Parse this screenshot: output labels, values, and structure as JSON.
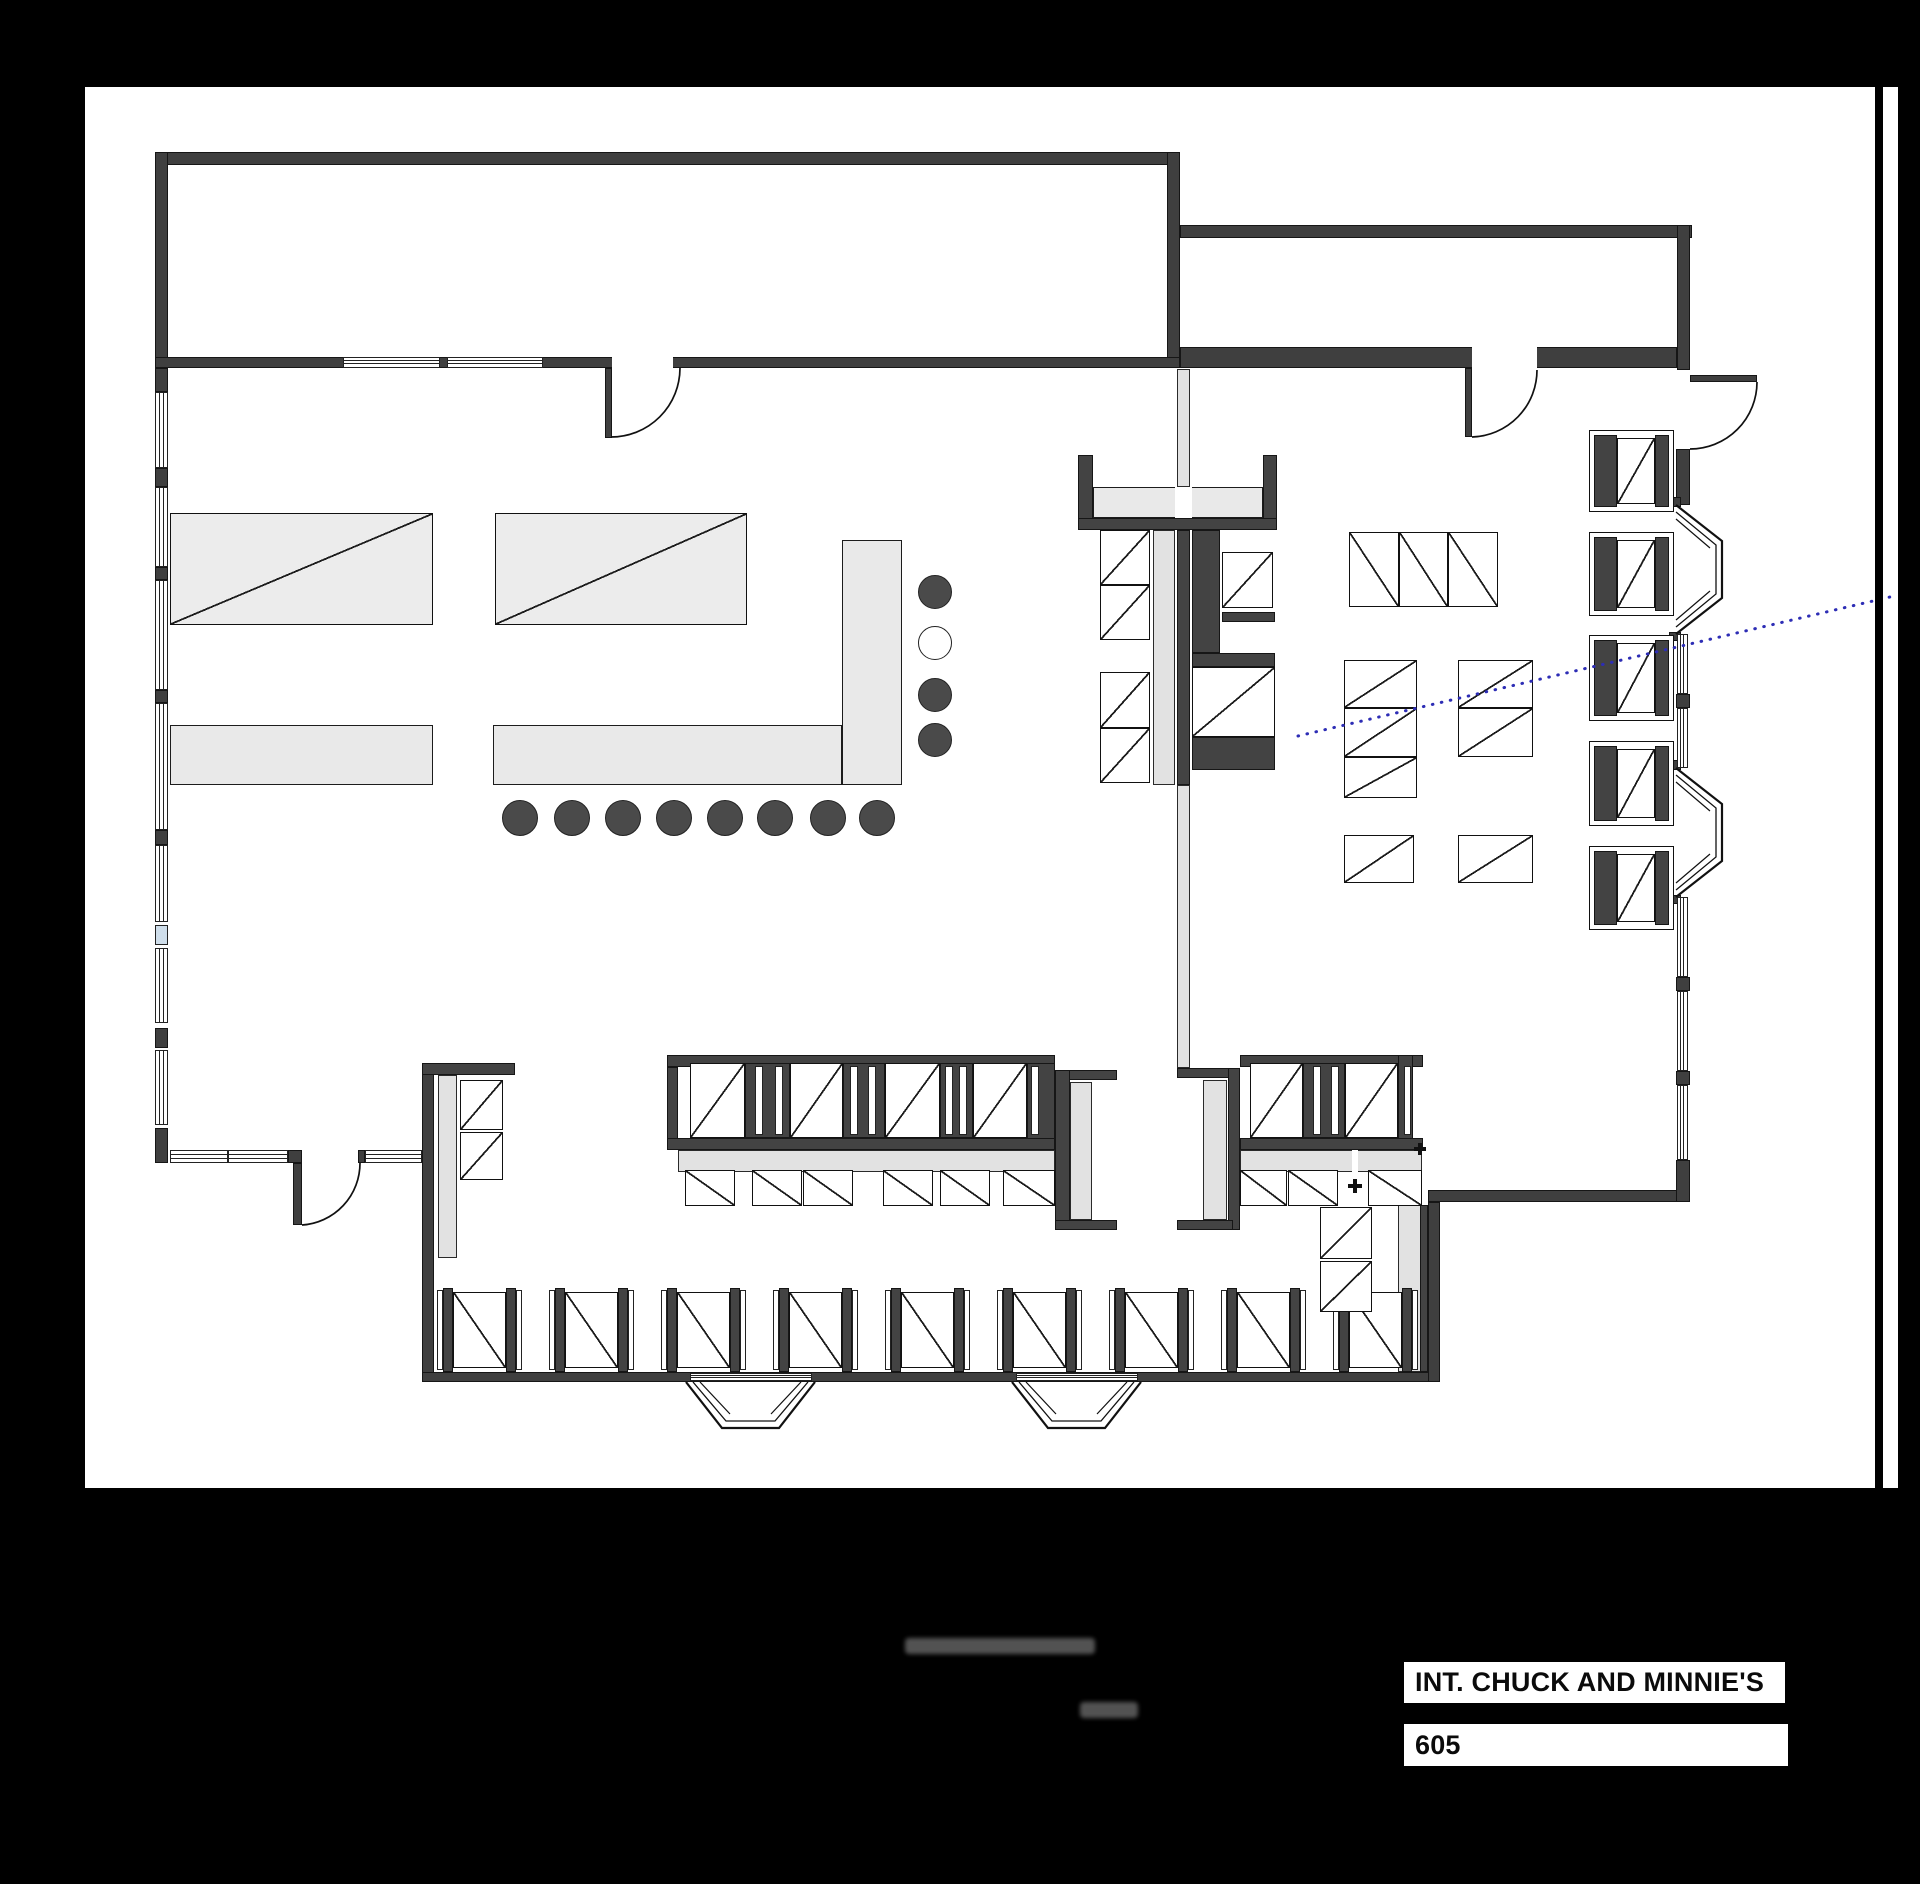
{
  "canvas": {
    "w": 1920,
    "h": 1884,
    "background": "#000000"
  },
  "sheet": {
    "x": 85,
    "y": 87,
    "w": 1813,
    "h": 1401,
    "background": "#ffffff"
  },
  "border_line": {
    "x": 1875,
    "y": 87,
    "w": 8,
    "h": 1401,
    "color": "#000000"
  },
  "title_block": {
    "scene_name": "INT. CHUCK AND MINNIE'S",
    "scene_number": "605",
    "name_box": {
      "x": 1404,
      "y": 1662,
      "w": 381,
      "h": 41
    },
    "number_box": {
      "x": 1404,
      "y": 1724,
      "w": 384,
      "h": 42
    }
  },
  "colors": {
    "wall": "#3f3f3f",
    "counter": "#e9e9e9",
    "bench": "#e2e2e2",
    "stool": "#4a4a4a",
    "glass": "#cfdeeb",
    "sightline": "#2d2db5",
    "line": "#111111"
  },
  "floorplan": {
    "rects": [
      [
        155,
        152,
        1025,
        13,
        "wall",
        "top-wall-back-room"
      ],
      [
        155,
        152,
        13,
        216,
        "wall",
        "left-wall-back-room"
      ],
      [
        1167,
        152,
        13,
        216,
        "wall",
        "divider-wall-back-rooms"
      ],
      [
        155,
        357,
        1025,
        11,
        "wall",
        "back-wall-diner"
      ],
      [
        1180,
        225,
        512,
        13,
        "wall",
        "top-wall-back-right-room"
      ],
      [
        1677,
        225,
        13,
        145,
        "wall",
        "right-wall-back-right-room"
      ],
      [
        1180,
        347,
        497,
        21,
        "wall",
        "bottom-wall-back-right-room"
      ],
      [
        612,
        357,
        61,
        12,
        "gap",
        "door-opening-back-wall"
      ],
      [
        1472,
        347,
        65,
        21,
        "gap",
        "door-opening-back-right-room"
      ],
      [
        605,
        368,
        7,
        70,
        "wall",
        "door-leaf-back-wall"
      ],
      [
        1465,
        368,
        7,
        69,
        "wall",
        "door-leaf-back-right-room"
      ],
      [
        1690,
        375,
        67,
        7,
        "wall",
        "door-leaf-exterior-right"
      ],
      [
        155,
        368,
        13,
        24,
        "wall",
        "left-wall-segment"
      ],
      [
        155,
        468,
        13,
        19,
        "wall",
        "left-wall-segment"
      ],
      [
        155,
        567,
        13,
        13,
        "wall",
        "left-wall-segment"
      ],
      [
        155,
        690,
        13,
        13,
        "wall",
        "left-wall-segment"
      ],
      [
        155,
        830,
        13,
        15,
        "wall",
        "left-wall-segment"
      ],
      [
        155,
        1028,
        13,
        20,
        "wall",
        "left-wall-segment"
      ],
      [
        155,
        1128,
        13,
        35,
        "wall",
        "left-wall-segment"
      ],
      [
        288,
        1150,
        14,
        13,
        "wall",
        "entry-door-jamb"
      ],
      [
        358,
        1150,
        7,
        13,
        "wall",
        "entry-door-jamb"
      ],
      [
        293,
        1163,
        9,
        62,
        "wall",
        "door-leaf-entry"
      ],
      [
        422,
        1063,
        12,
        319,
        "wall",
        "lower-left-wall"
      ],
      [
        422,
        1372,
        1018,
        10,
        "wall",
        "bottom-wall"
      ],
      [
        1428,
        1202,
        12,
        180,
        "wall",
        "lower-right-wall-vertical"
      ],
      [
        1428,
        1190,
        262,
        12,
        "wall",
        "lower-right-wall-horizontal"
      ],
      [
        1676,
        449,
        14,
        56,
        "wall",
        "right-wall-segment"
      ],
      [
        1676,
        694,
        14,
        14,
        "wall",
        "right-wall-stub"
      ],
      [
        1676,
        977,
        14,
        14,
        "wall",
        "right-wall-stub"
      ],
      [
        1676,
        1071,
        14,
        14,
        "wall",
        "right-wall-stub"
      ],
      [
        1676,
        1160,
        14,
        42,
        "wall",
        "right-wall-segment"
      ],
      [
        1669,
        497,
        12,
        10,
        "wall",
        "bay-window-anchor"
      ],
      [
        1669,
        632,
        12,
        9,
        "wall",
        "bay-window-anchor"
      ],
      [
        1669,
        760,
        12,
        10,
        "wall",
        "bay-window-anchor"
      ],
      [
        1669,
        895,
        12,
        9,
        "wall",
        "bay-window-anchor"
      ],
      [
        170,
        725,
        263,
        60,
        "counter",
        "prep-counter"
      ],
      [
        493,
        725,
        349,
        60,
        "counter",
        "lunch-counter"
      ],
      [
        842,
        540,
        60,
        245,
        "counter",
        "lunch-counter-return"
      ],
      [
        845,
        727,
        55,
        56,
        "patch",
        "lunch-counter-corner"
      ],
      [
        1078,
        455,
        15,
        65,
        "dark",
        "island-post"
      ],
      [
        1263,
        455,
        14,
        65,
        "dark",
        "island-post"
      ],
      [
        1093,
        487,
        170,
        31,
        "counter",
        "island-pass-counter"
      ],
      [
        1175,
        487,
        17,
        31,
        "gap",
        "island-pass-gap"
      ],
      [
        1078,
        518,
        199,
        12,
        "dark",
        "island-counter-back"
      ],
      [
        1177,
        369,
        13,
        118,
        "bench",
        "service-partition"
      ],
      [
        1153,
        530,
        22,
        255,
        "bench",
        "island-bench"
      ],
      [
        1177,
        530,
        13,
        255,
        "dark",
        "island-spine"
      ],
      [
        1177,
        785,
        13,
        283,
        "bench",
        "service-partition-lower"
      ],
      [
        1192,
        530,
        28,
        123,
        "dark",
        "island-equipment-block"
      ],
      [
        1222,
        612,
        53,
        10,
        "dark",
        "island-shelf"
      ],
      [
        1192,
        653,
        83,
        14,
        "dark",
        "island-shelf"
      ],
      [
        1192,
        737,
        83,
        33,
        "dark",
        "island-base"
      ],
      [
        422,
        1063,
        93,
        12,
        "dark",
        "left-booth-cap"
      ],
      [
        438,
        1075,
        19,
        183,
        "bench",
        "left-booth-bench"
      ],
      [
        667,
        1055,
        388,
        12,
        "dark",
        "booth-row-left-top-band"
      ],
      [
        667,
        1067,
        11,
        83,
        "dark",
        "booth-row-left-post"
      ],
      [
        745,
        1063,
        45,
        75,
        "dark",
        "booth-divider"
      ],
      [
        843,
        1063,
        42,
        75,
        "dark",
        "booth-divider"
      ],
      [
        940,
        1063,
        33,
        75,
        "dark",
        "booth-divider"
      ],
      [
        1027,
        1063,
        28,
        87,
        "dark",
        "booth-divider"
      ],
      [
        1055,
        1070,
        62,
        10,
        "dark",
        "booth-endcap-flange"
      ],
      [
        1055,
        1070,
        15,
        160,
        "dark",
        "booth-endcap-spine"
      ],
      [
        1070,
        1082,
        22,
        138,
        "bench",
        "booth-endcap-bench"
      ],
      [
        1055,
        1220,
        62,
        10,
        "dark",
        "booth-endcap-flange"
      ],
      [
        667,
        1138,
        388,
        12,
        "dark",
        "booth-row-left-bottom-band"
      ],
      [
        678,
        1150,
        377,
        22,
        "bench",
        "booth-row-left-bench"
      ],
      [
        1177,
        1068,
        56,
        10,
        "dark",
        "booth-endcap-flange"
      ],
      [
        1203,
        1080,
        24,
        140,
        "bench",
        "booth-endcap-bench"
      ],
      [
        1228,
        1068,
        12,
        162,
        "dark",
        "booth-endcap-spine"
      ],
      [
        1177,
        1220,
        56,
        10,
        "dark",
        "booth-endcap-flange"
      ],
      [
        1240,
        1055,
        183,
        12,
        "dark",
        "booth-row-right-top-band"
      ],
      [
        1303,
        1063,
        42,
        75,
        "dark",
        "booth-divider"
      ],
      [
        1398,
        1055,
        15,
        95,
        "dark",
        "booth-row-right-post"
      ],
      [
        1240,
        1138,
        183,
        12,
        "dark",
        "booth-row-right-bottom-band"
      ],
      [
        1240,
        1150,
        182,
        22,
        "bench",
        "booth-row-right-bench"
      ],
      [
        1352,
        1150,
        6,
        22,
        "gap",
        "bench-gap"
      ],
      [
        1398,
        1205,
        24,
        167,
        "bench",
        "corner-booth-bench"
      ],
      [
        1420,
        1205,
        8,
        167,
        "dark",
        "corner-booth-spine"
      ]
    ],
    "tables": [
      [
        170,
        513,
        263,
        112,
        "b",
        "kitchen-table",
        "#ececec"
      ],
      [
        495,
        513,
        252,
        112,
        "b",
        "kitchen-table",
        "#ececec"
      ],
      [
        1100,
        530,
        50,
        55,
        "b",
        "island-table"
      ],
      [
        1100,
        585,
        50,
        55,
        "b",
        "island-table"
      ],
      [
        1100,
        672,
        50,
        56,
        "b",
        "island-table"
      ],
      [
        1100,
        728,
        50,
        55,
        "b",
        "island-table"
      ],
      [
        1222,
        552,
        51,
        56,
        "b",
        "island-table"
      ],
      [
        1192,
        667,
        83,
        70,
        "b",
        "island-table"
      ],
      [
        1349,
        532,
        50,
        75,
        "f",
        "dining-table"
      ],
      [
        1399,
        532,
        49,
        75,
        "f",
        "dining-table"
      ],
      [
        1448,
        532,
        50,
        75,
        "f",
        "dining-table"
      ],
      [
        1344,
        660,
        73,
        48,
        "b",
        "dining-table"
      ],
      [
        1344,
        708,
        73,
        49,
        "b",
        "dining-table"
      ],
      [
        1344,
        757,
        73,
        41,
        "b",
        "dining-table"
      ],
      [
        1458,
        660,
        75,
        48,
        "b",
        "dining-table"
      ],
      [
        1458,
        708,
        75,
        49,
        "b",
        "dining-table"
      ],
      [
        1344,
        835,
        70,
        48,
        "b",
        "dining-table"
      ],
      [
        1458,
        835,
        75,
        48,
        "b",
        "dining-table"
      ],
      [
        690,
        1063,
        55,
        75,
        "b",
        "booth-table"
      ],
      [
        790,
        1063,
        53,
        75,
        "b",
        "booth-table"
      ],
      [
        885,
        1063,
        55,
        75,
        "b",
        "booth-table"
      ],
      [
        973,
        1063,
        54,
        75,
        "b",
        "booth-table"
      ],
      [
        685,
        1170,
        50,
        36,
        "f",
        "booth-table"
      ],
      [
        752,
        1170,
        50,
        36,
        "f",
        "booth-table"
      ],
      [
        803,
        1170,
        50,
        36,
        "f",
        "booth-table"
      ],
      [
        883,
        1170,
        50,
        36,
        "f",
        "booth-table"
      ],
      [
        940,
        1170,
        50,
        36,
        "f",
        "booth-table"
      ],
      [
        1003,
        1170,
        52,
        36,
        "f",
        "booth-table"
      ],
      [
        1250,
        1063,
        53,
        75,
        "b",
        "booth-table"
      ],
      [
        1345,
        1063,
        53,
        75,
        "b",
        "booth-table"
      ],
      [
        1240,
        1170,
        47,
        36,
        "f",
        "booth-table"
      ],
      [
        1288,
        1170,
        50,
        36,
        "f",
        "booth-table"
      ],
      [
        1368,
        1170,
        54,
        36,
        "f",
        "booth-table"
      ],
      [
        460,
        1080,
        43,
        50,
        "b",
        "booth-table"
      ],
      [
        460,
        1132,
        43,
        48,
        "b",
        "booth-table"
      ],
      [
        1320,
        1207,
        52,
        52,
        "b",
        "corner-booth-table"
      ],
      [
        1320,
        1261,
        52,
        51,
        "b",
        "corner-booth-table"
      ]
    ],
    "slits": [
      [
        755,
        1066,
        8,
        69
      ],
      [
        775,
        1066,
        8,
        69
      ],
      [
        850,
        1066,
        8,
        69
      ],
      [
        868,
        1066,
        8,
        69
      ],
      [
        945,
        1066,
        8,
        69
      ],
      [
        959,
        1066,
        8,
        69
      ],
      [
        1031,
        1066,
        8,
        69
      ],
      [
        1313,
        1066,
        8,
        69
      ],
      [
        1331,
        1066,
        8,
        69
      ],
      [
        1404,
        1066,
        7,
        69
      ]
    ],
    "windows_h": [
      [
        343,
        357,
        97,
        11
      ],
      [
        447,
        357,
        96,
        11
      ],
      [
        170,
        1150,
        58,
        13
      ],
      [
        228,
        1150,
        60,
        13
      ],
      [
        365,
        1150,
        57,
        13
      ],
      [
        690,
        1373,
        122,
        8
      ],
      [
        1016,
        1373,
        122,
        8
      ]
    ],
    "windows_v": [
      [
        155,
        392,
        13,
        76
      ],
      [
        155,
        487,
        13,
        80
      ],
      [
        155,
        580,
        13,
        110
      ],
      [
        155,
        703,
        13,
        127
      ],
      [
        155,
        845,
        13,
        77
      ],
      [
        155,
        948,
        13,
        75
      ],
      [
        155,
        1050,
        13,
        75
      ],
      [
        1677,
        634,
        11,
        60
      ],
      [
        1677,
        708,
        11,
        60
      ],
      [
        1677,
        897,
        11,
        80
      ],
      [
        1677,
        991,
        11,
        80
      ],
      [
        1677,
        1085,
        11,
        75
      ]
    ],
    "glass_panes": [
      [
        155,
        925,
        13,
        20
      ]
    ],
    "right_booths": {
      "x": 1589,
      "w": 85,
      "bench_left_w": 23,
      "bench_right_w": 14,
      "table_x": 1617,
      "table_w": 38,
      "units": [
        {
          "y": 430,
          "h": 82
        },
        {
          "y": 532,
          "h": 84
        },
        {
          "y": 635,
          "h": 86
        },
        {
          "y": 741,
          "h": 85
        },
        {
          "y": 846,
          "h": 84
        }
      ]
    },
    "bottom_booths": {
      "y": 1288,
      "unit_w": 85,
      "xs": [
        437,
        549,
        661,
        773,
        885,
        997,
        1109,
        1221,
        1333
      ]
    },
    "stools_counter": {
      "cy": 818,
      "r": 18,
      "xs": [
        520,
        572,
        623,
        674,
        725,
        775,
        828,
        877
      ]
    },
    "stools_return": {
      "cx": 935,
      "r": 17,
      "items": [
        {
          "y": 592
        },
        {
          "y": 643,
          "open": true
        },
        {
          "y": 695
        },
        {
          "y": 740
        }
      ]
    },
    "plus_markers": [
      [
        1348,
        1179,
        14
      ],
      [
        1414,
        1143,
        12
      ]
    ],
    "door_arcs": [
      "M 611 437 A 69 69 0 0 0 680 368",
      "M 1472 437 A 67 67 0 0 0 1537 370",
      "M 1757 382 A 67 67 0 0 1 1690 449",
      "M 302 1225 A 62 62 0 0 0 360 1163"
    ],
    "bay_windows": [
      {
        "outer": "M1676 505 L1722 541 L1722 598 L1676 634",
        "inner": "M1676 512 L1716 545 L1716 594 L1676 627",
        "hatch": "M1676 519 L1710 548 M1676 620 L1710 591"
      },
      {
        "outer": "M1676 768 L1722 804 L1722 861 L1676 897",
        "inner": "M1676 775 L1716 808 L1716 857 L1676 890",
        "hatch": "M1676 782 L1710 811 M1676 883 L1710 854"
      },
      {
        "outer": "M686 1382 L722 1428 L779 1428 L815 1382",
        "inner": "M693 1382 L726 1421 L775 1421 L808 1382",
        "hatch": "M700 1382 L730 1414 M801 1382 L771 1414"
      },
      {
        "outer": "M1012 1382 L1048 1428 L1105 1428 L1141 1382",
        "inner": "M1019 1382 L1052 1421 L1101 1421 L1134 1382",
        "hatch": "M1026 1382 L1056 1414 M1127 1382 L1097 1414"
      }
    ],
    "camera_sightline": {
      "x1": 1298,
      "y1": 736,
      "x2": 1890,
      "y2": 597
    },
    "smudges": [
      [
        905,
        1638,
        190,
        16
      ],
      [
        1080,
        1702,
        58,
        16
      ]
    ]
  }
}
